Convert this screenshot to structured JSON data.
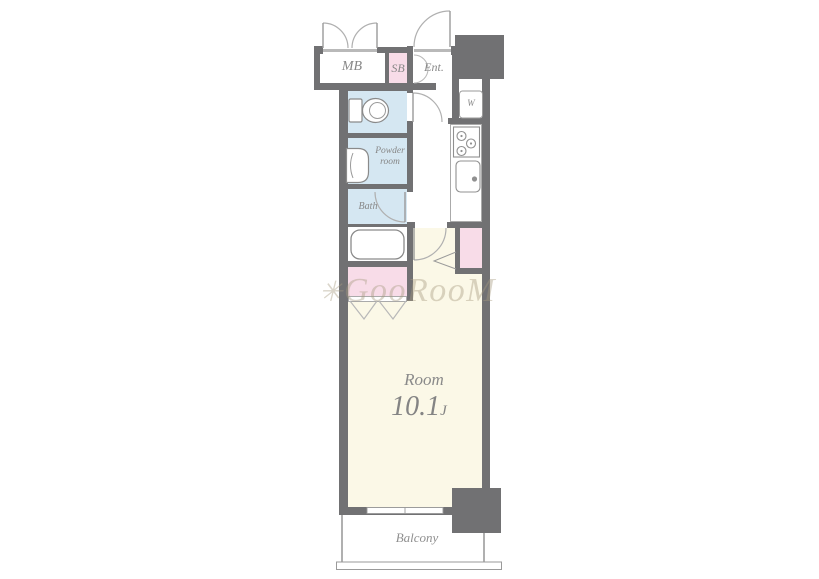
{
  "type": "floor_plan",
  "unit": {
    "labels": {
      "mb": "MB",
      "sb": "SB",
      "ent": "Ent.",
      "w": "W",
      "powder_line1": "Powder",
      "powder_line2": "room",
      "bath": "Bath",
      "room_name": "Room",
      "room_size": "10.1",
      "room_size_unit": "J",
      "balcony": "Balcony"
    },
    "main_room": {
      "name": "Room",
      "size_jo": "10.1J"
    },
    "rooms": [
      "MB",
      "SB",
      "Ent.",
      "Powder room",
      "Bath",
      "Room 10.1J",
      "Balcony"
    ]
  },
  "watermark": {
    "mark": "✳",
    "text": "GooRooM"
  },
  "colors": {
    "wall": "#717173",
    "water_blue": "#d5e7f2",
    "closet_pink": "#f8dce8",
    "room_cream": "#fbf8e7",
    "line_gray": "#a8a8a8",
    "label_gray": "#8a8a8a"
  }
}
